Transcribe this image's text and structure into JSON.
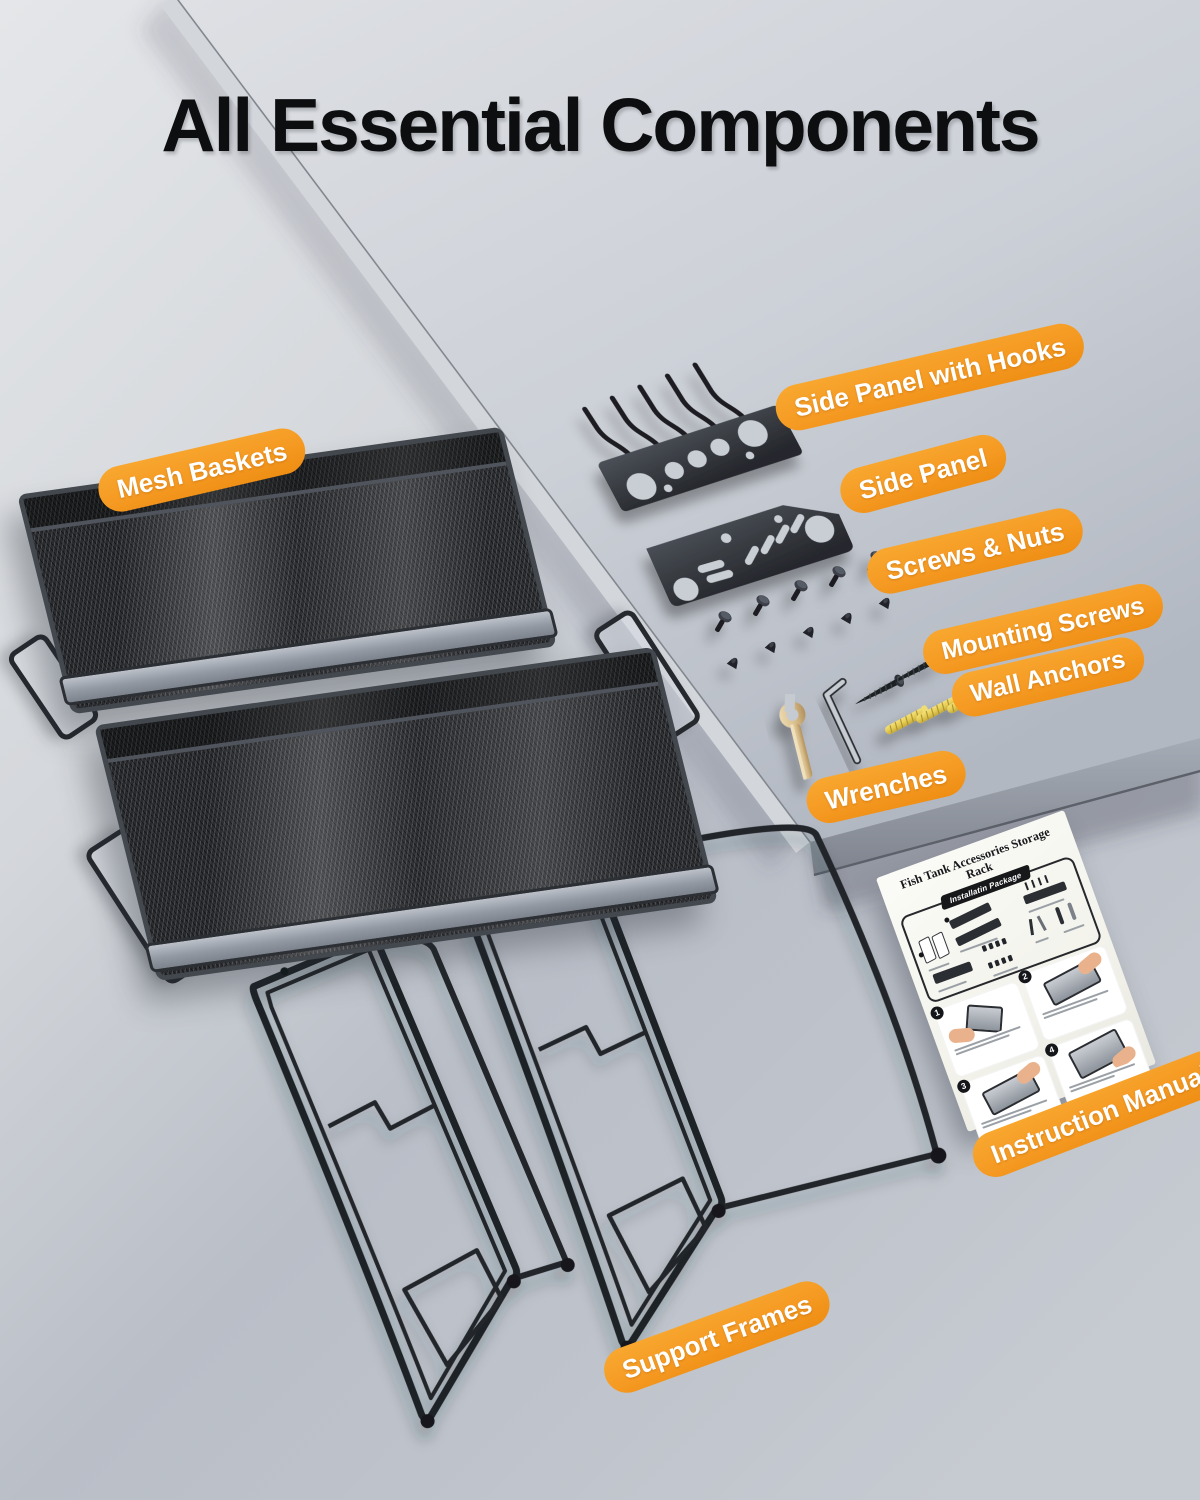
{
  "header": {
    "title": "All Essential Components"
  },
  "labels": {
    "mesh_baskets": "Mesh Baskets",
    "side_panel_with_hooks": "Side Panel with Hooks",
    "side_panel": "Side Panel",
    "screws_and_nuts": "Screws & Nuts",
    "mounting_screws": "Mounting Screws",
    "wall_anchors": "Wall Anchors",
    "wrenches": "Wrenches",
    "instruction_manual": "Instruction Manual",
    "support_frames": "Support Frames"
  },
  "manual": {
    "title": "Fish Tank Accessories Storage Rack",
    "badge": "Installatin Package",
    "steps": [
      "1",
      "2",
      "3",
      "4"
    ]
  },
  "colors": {
    "accent_orange": "#F59A23",
    "label_text": "#FFFFFF",
    "title_text": "#0D0E10",
    "metal_dark": "#26282C",
    "anchor_yellow": "#E6CD55",
    "wrench_gold": "#D8BE8C"
  }
}
